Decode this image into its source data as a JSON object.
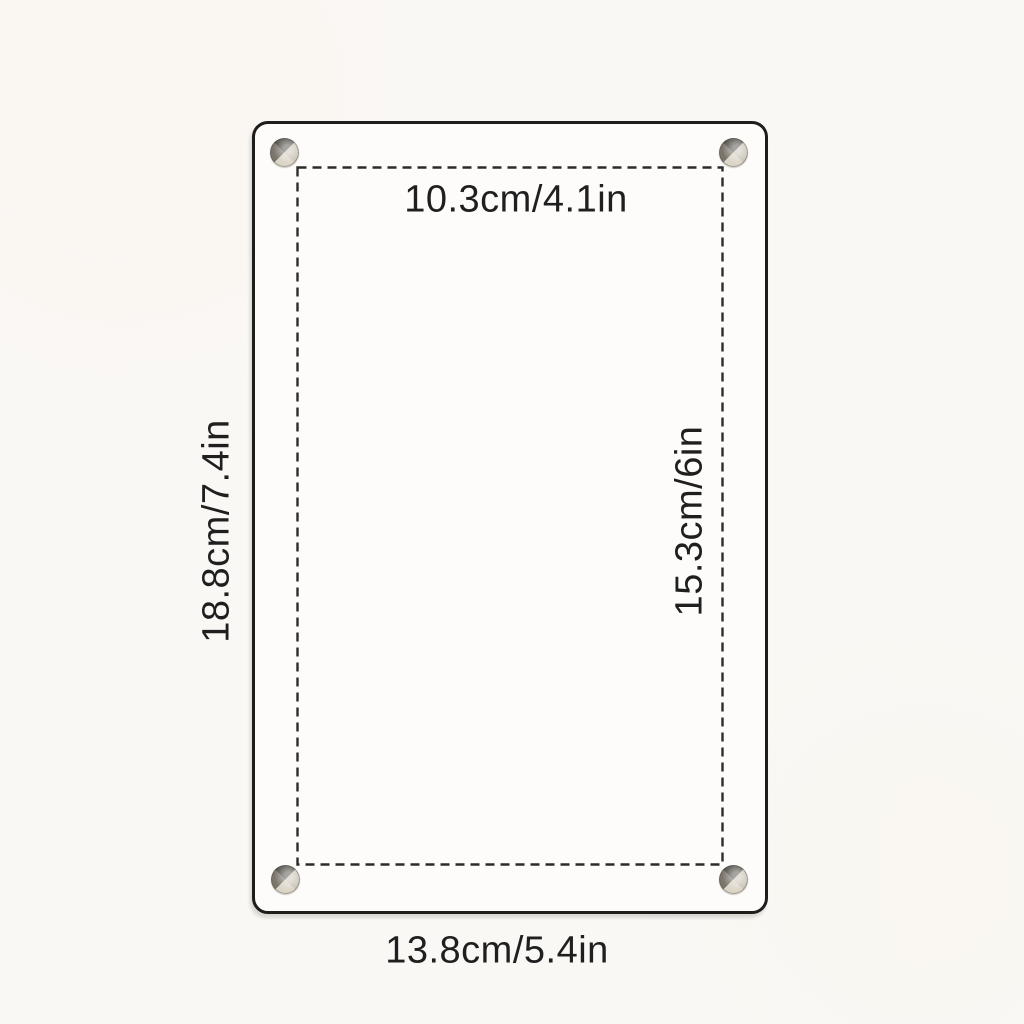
{
  "diagram": {
    "type": "product-dimension-diagram",
    "product": "acrylic frame with corner standoff screws",
    "labels": {
      "inner_width": "10.3cm/4.1in",
      "outer_width": "13.8cm/5.4in",
      "outer_height": "18.8cm/7.4in",
      "inner_height": "15.3cm/6in"
    },
    "measurements": {
      "inner_width_cm": 10.3,
      "inner_width_in": 4.1,
      "outer_width_cm": 13.8,
      "outer_width_in": 5.4,
      "outer_height_cm": 18.8,
      "outer_height_in": 7.4,
      "inner_height_cm": 15.3,
      "inner_height_in": 6
    },
    "colors": {
      "background": "#f9f8f5",
      "frame_fill": "#fdfcfa",
      "frame_border": "#1d1d1b",
      "dashed_line": "#2b2b2b",
      "text": "#1f1f1f",
      "screw_light": "#dbd5c7",
      "screw_mid": "#7a756c",
      "screw_dark": "#4e4a43"
    },
    "style": {
      "outer_outline": "solid rounded rectangle",
      "inner_outline": "dashed rectangle",
      "screw_count": 4
    }
  }
}
